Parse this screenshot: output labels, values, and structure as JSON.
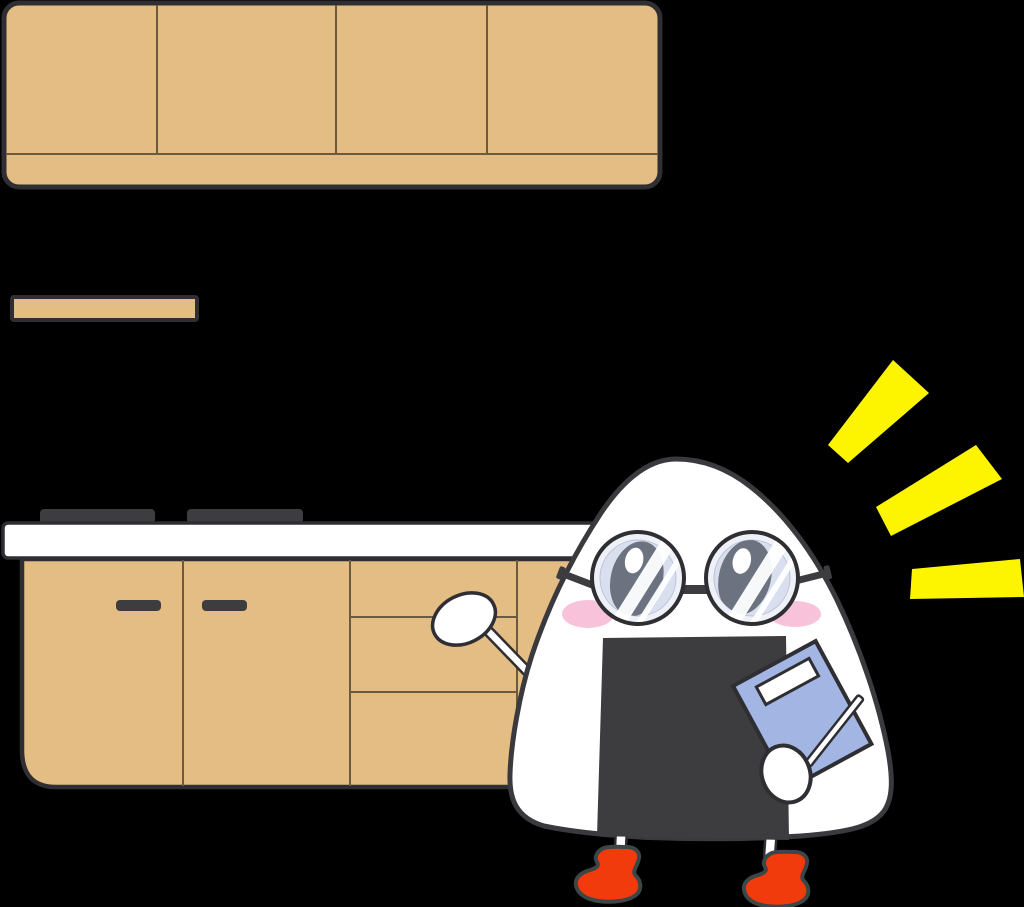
{
  "title": "Cartoon onigiri (rice ball) teacher with round glasses holding a blue notebook and pencil, standing beside a kitchen counter with wooden cabinets, a stove top, a rice paddle, and yellow sparkle rays",
  "palette": {
    "bg": "#000000",
    "wood": "#e3bd83",
    "outline": "#2e2e33",
    "dark": "#3d3d40",
    "white": "#ffffff",
    "lensOuter": "#eef1f8",
    "lensInner": "#d9dfee",
    "pupil": "#6d7280",
    "cheek": "#f8c3da",
    "book": "#a3b6e3",
    "shoe": "#f23b0c",
    "shoeOutline": "#3c4647",
    "spark": "#fdf400",
    "innerline": "#6b5a3e"
  },
  "objects": [
    "upper-wall-cabinets-4-doors",
    "wall-shelf",
    "stove-burners-2",
    "white-countertop",
    "base-cabinets-with-handles-and-drawers",
    "rice-paddle",
    "sparkle-rays-3",
    "onigiri-character",
    "round-glasses",
    "nori-seaweed-apron",
    "blue-notebook-with-white-label",
    "pencil",
    "red-shoes"
  ]
}
